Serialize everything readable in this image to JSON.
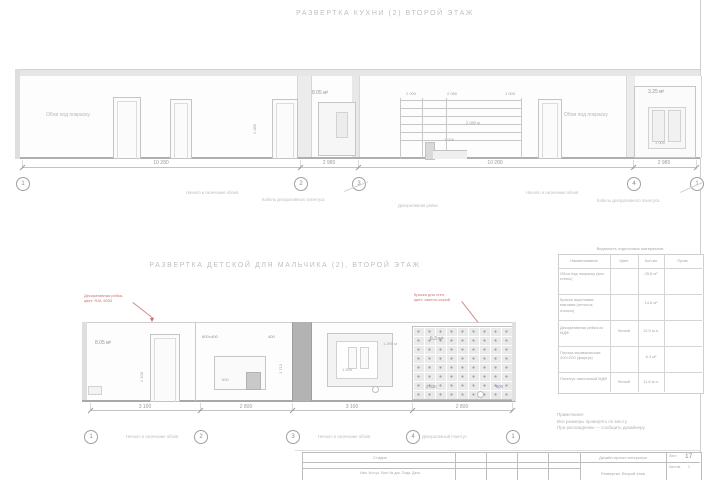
{
  "titles": {
    "top": "РАЗВЕРТКА КУХНИ (2) ВТОРОЙ ЭТАЖ",
    "bottom": "РАЗВЕРТКА ДЕТСКОЙ ДЛЯ МАЛЬЧИКА (2), ВТОРОЙ ЭТАЖ"
  },
  "top_drawing": {
    "finish_left": "Обои под покраску",
    "finish_right": "Обои под покраску",
    "area_mid": "8.05 м²",
    "area_cabinet": "3.25 м²",
    "door_height": "2 080",
    "stair": {
      "dim1": "2 000",
      "dim2": "2 080",
      "dim3": "1 000",
      "dim_mid": "2 080 м",
      "dim_step": "1 000"
    },
    "cabinet_width": "1 000",
    "dims": [
      "10 280",
      "2 985",
      "10 280",
      "2 985"
    ],
    "callouts": [
      "1",
      "2",
      "3",
      "4",
      "1"
    ],
    "leader1": "Начало и окончание обоев",
    "leader2": "Кабель декоративного плинтуса",
    "leader3": "Декоративная рейка",
    "leader4": "Начало и окончание обоев",
    "leader5": "Кабель декоративного плинтуса"
  },
  "bottom_drawing": {
    "red_left1": "Декоративная рейка,",
    "red_left2": "цвет: RAL 9003",
    "red_right1": "Краска для стен,",
    "red_right2": "цвет: светло-серый",
    "area_left": "8.05 м²",
    "area_tile": "6.3 м²",
    "door_height": "2 100",
    "label_tv": "600×400",
    "label_shelf": "400",
    "desk_dim": "600",
    "side_dim": "1 713",
    "niche_label": "1 295 м",
    "niche_dim": "1 555",
    "tile_blue_left": "2 030",
    "tile_blue_right": "800",
    "dims": [
      "3 100",
      "2 800",
      "3 100",
      "2 800"
    ],
    "callouts": [
      "1",
      "2",
      "3",
      "4",
      "1"
    ],
    "leader1": "Начало и окончание обоев",
    "leader2": "Начало и окончание обоев",
    "leader3": "Декоративный плинтус"
  },
  "table": {
    "title": "Ведомость отделочных материалов",
    "headers": [
      "Наименование",
      "Цвет",
      "Кол-во",
      "Прим."
    ],
    "rows": [
      {
        "name": "Обои под покраску (все стены)",
        "color": "",
        "qty": "25.8 м²",
        "note": ""
      },
      {
        "name": "Краска акриловая матовая (потолок, откосы)",
        "color": "",
        "qty": "14.6 м²",
        "note": ""
      },
      {
        "name": "Декоративная рейка из МДФ",
        "color": "белый",
        "qty": "12.5 м.п.",
        "note": ""
      },
      {
        "name": "Плитка керамическая 200×200 (фартук)",
        "color": "",
        "qty": "6.3 м²",
        "note": ""
      },
      {
        "name": "Плинтус напольный МДФ",
        "color": "белый",
        "qty": "11.8 м.п.",
        "note": ""
      }
    ]
  },
  "notes": {
    "l1": "Примечание:",
    "l2": "Все размеры проверять по месту.",
    "l3": "При расхождении — сообщить дизайнеру."
  },
  "titleblock": {
    "stage_label": "Стадия",
    "row2": "Изм.   Кол.уч.   Лист   № док.   Подп.   Дата",
    "project": "Дизайн-проект интерьера",
    "drawing": "Развертки. Второй этаж",
    "sheet_label": "Лист",
    "sheets_label": "Листов",
    "sheet_num": "17",
    "sheets_num": "1"
  }
}
